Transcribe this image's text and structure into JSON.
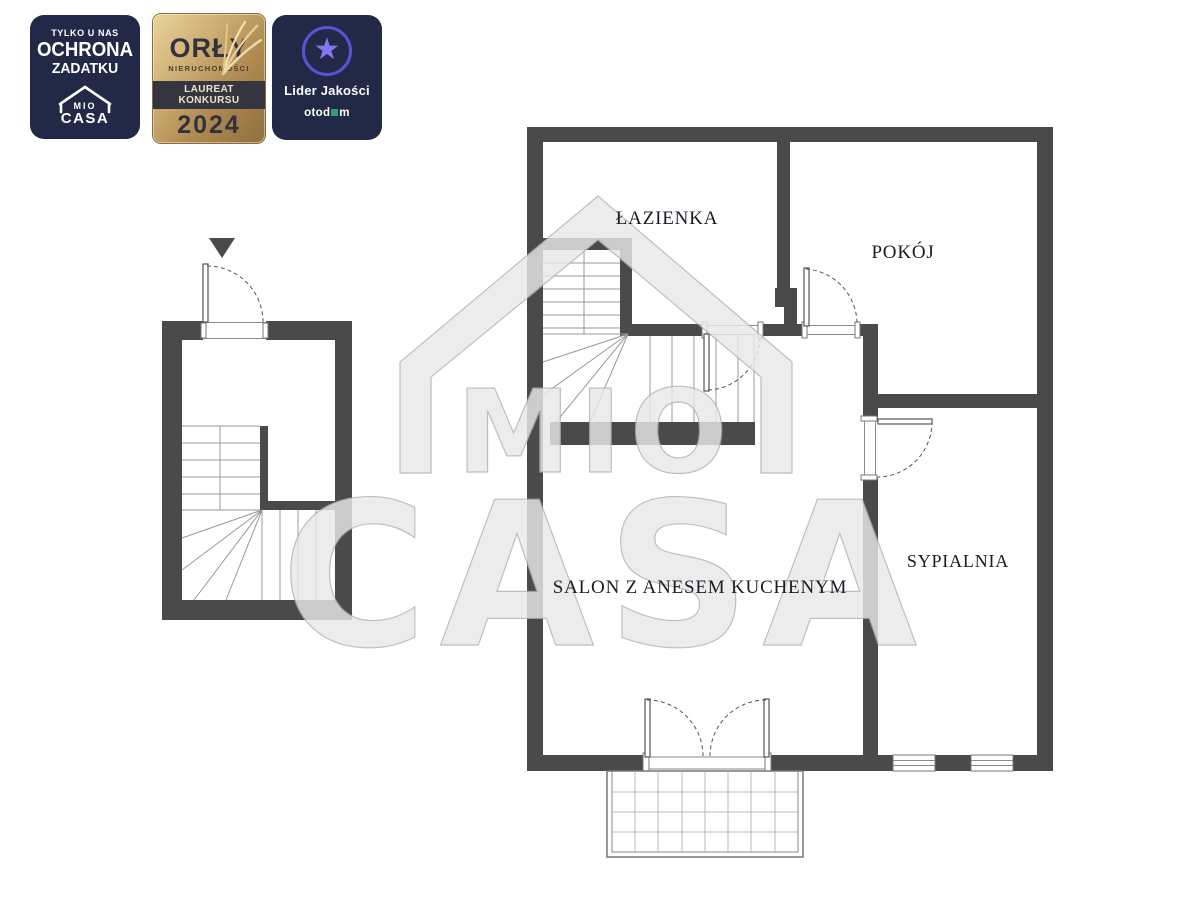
{
  "badges": {
    "ochrona": {
      "line1": "TYLKO U NAS",
      "line2": "OCHRONA",
      "line3": "ZADATKU",
      "logo_top": "MIO",
      "logo_bottom": "CASA"
    },
    "orly": {
      "title": "ORŁY",
      "subtitle": "NIERUCHOMOŚCI",
      "band": "LAUREAT KONKURSU",
      "year": "2024"
    },
    "lider": {
      "title": "Lider Jakości",
      "star": "★",
      "brand_prefix": "otod",
      "brand_suffix": "m"
    }
  },
  "watermark": {
    "line1": "MIO",
    "line2": "CASA"
  },
  "floorplan": {
    "rooms": [
      {
        "id": "lazienka",
        "label": "ŁAZIENKA"
      },
      {
        "id": "pokoj",
        "label": "POKÓJ"
      },
      {
        "id": "sypialnia",
        "label": "SYPIALNIA"
      },
      {
        "id": "salon",
        "label": "SALON Z ANESEM KUCHENYM"
      }
    ]
  },
  "colors": {
    "wall": "#4A4A4A",
    "badge_navy": "#212946",
    "gold_light": "#E9D49C",
    "gold_dark": "#8F6F40",
    "band_dark": "#35353F",
    "purple_star": "#8577EF",
    "purple_ring": "#5F4FD6",
    "otodom_green": "#2F9E78",
    "label_text": "#1B1B26",
    "watermark_gray": "#E9E9E9"
  }
}
